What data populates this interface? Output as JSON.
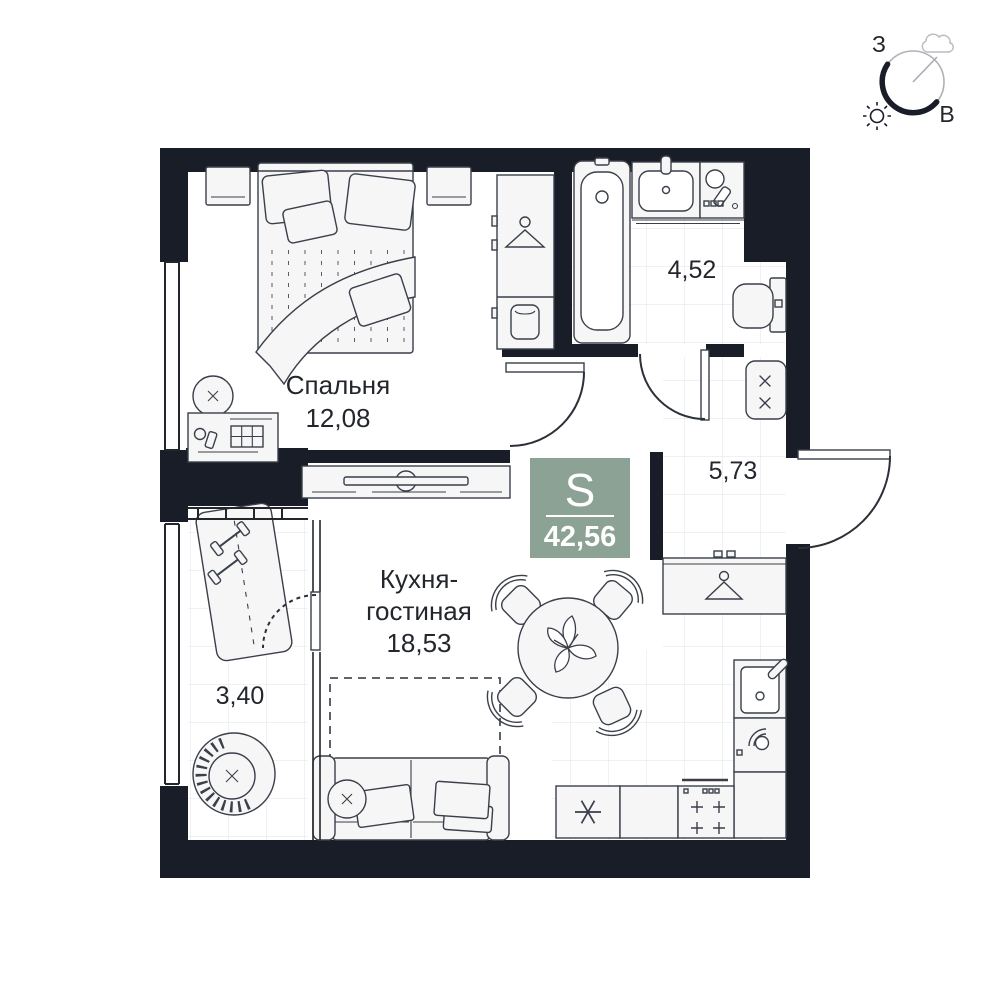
{
  "rooms": {
    "bedroom": {
      "label": "Спальня",
      "area": "12,08"
    },
    "kitchen_living": {
      "label_line1": "Кухня-",
      "label_line2": "гостиная",
      "area": "18,53"
    },
    "bathroom": {
      "area": "4,52"
    },
    "hallway": {
      "area": "5,73"
    },
    "loggia": {
      "area": "3,40"
    }
  },
  "total_area_badge": {
    "letter": "S",
    "value": "42,56",
    "color": "#8BA294"
  },
  "compass": {
    "west_label": "З",
    "east_label": "В"
  },
  "colors": {
    "wall": "#191D28",
    "floor": "#FFFFFF",
    "tile_line": "#E2E3E6",
    "furniture_fill": "#F6F6F7",
    "outline": "#3A3F49",
    "text": "#23262C",
    "badge_green": "#8BA294"
  },
  "icons": {
    "sun-icon": "☀",
    "cloud-icon": "☁",
    "hanger-icon": "clothes-hanger",
    "snowflake-icon": "✳",
    "burner-cross-icon": "×",
    "plus-burner-icon": "+"
  }
}
